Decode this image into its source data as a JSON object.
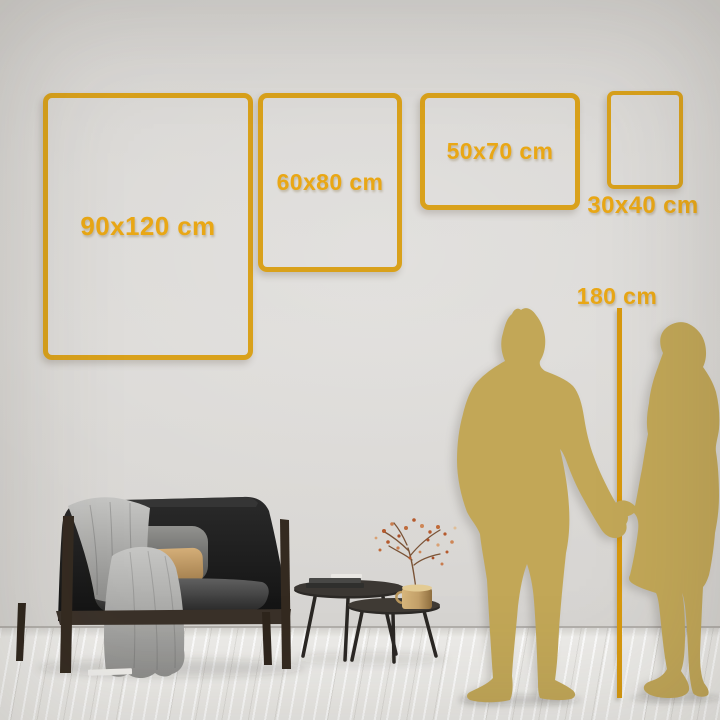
{
  "colors": {
    "frame_gold": "#D9A11B",
    "label_gold": "#E9A715",
    "line_gold": "#D8990E",
    "silhouette_gold": "#C2A757",
    "wall": "#D9D7D4",
    "floor": "#EDECE9"
  },
  "size_guide": {
    "unit": "cm",
    "frames": [
      {
        "id": "90x120",
        "label": "90x120 cm",
        "width_cm": 90,
        "height_cm": 120
      },
      {
        "id": "60x80",
        "label": "60x80 cm",
        "width_cm": 60,
        "height_cm": 80
      },
      {
        "id": "50x70",
        "label": "50x70 cm",
        "width_cm": 50,
        "height_cm": 70
      },
      {
        "id": "30x40",
        "label": "30x40 cm",
        "width_cm": 30,
        "height_cm": 40
      }
    ],
    "height_reference": {
      "label": "180 cm",
      "value_cm": 180
    }
  },
  "scene": {
    "icons": [
      "couple-silhouette-icon",
      "sofa-icon",
      "throw-blanket-icon",
      "pillows-icon",
      "coffee-tables-icon",
      "vase-with-dried-flowers-icon",
      "books-icon"
    ]
  }
}
